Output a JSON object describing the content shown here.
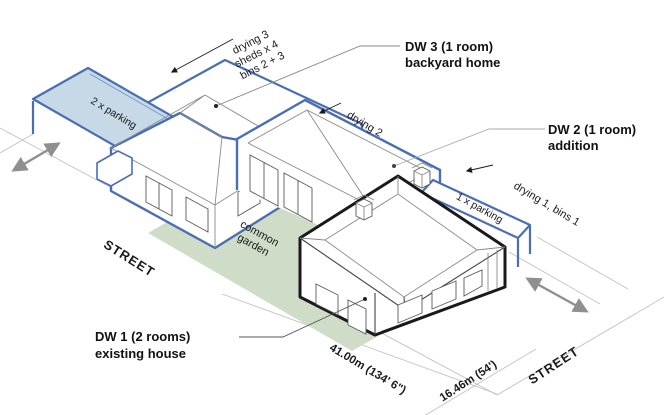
{
  "diagram": {
    "labels": {
      "dw3": {
        "line1": "DW 3 (1 room)",
        "line2": "backyard home"
      },
      "dw2": {
        "line1": "DW 2 (1 room)",
        "line2": "addition"
      },
      "dw1": {
        "line1": "DW 1 (2 rooms)",
        "line2": "existing house"
      }
    },
    "annotations": {
      "backyard": {
        "line1": "drying 3",
        "line2": "sheds x 4",
        "line3": "bins 2 + 3"
      },
      "drying2": "drying 2",
      "drying1_bins1": "drying 1, bins 1",
      "parking2": "2 x parking",
      "parking1": "1 x parking",
      "garden": {
        "line1": "common",
        "line2": "garden"
      }
    },
    "streets": {
      "left": "STREET",
      "right": "STREET"
    },
    "dimensions": {
      "length": "41.00m (134' 6\")",
      "width": "16.46m (54')"
    },
    "colors": {
      "new_works_blue": "#4a6eb4",
      "parking_fill": "#c7d9e6",
      "garden_fill": "#cfdcc8",
      "existing_black": "#1a1a1a",
      "street_arrow_gray": "#8f8f8f"
    }
  }
}
